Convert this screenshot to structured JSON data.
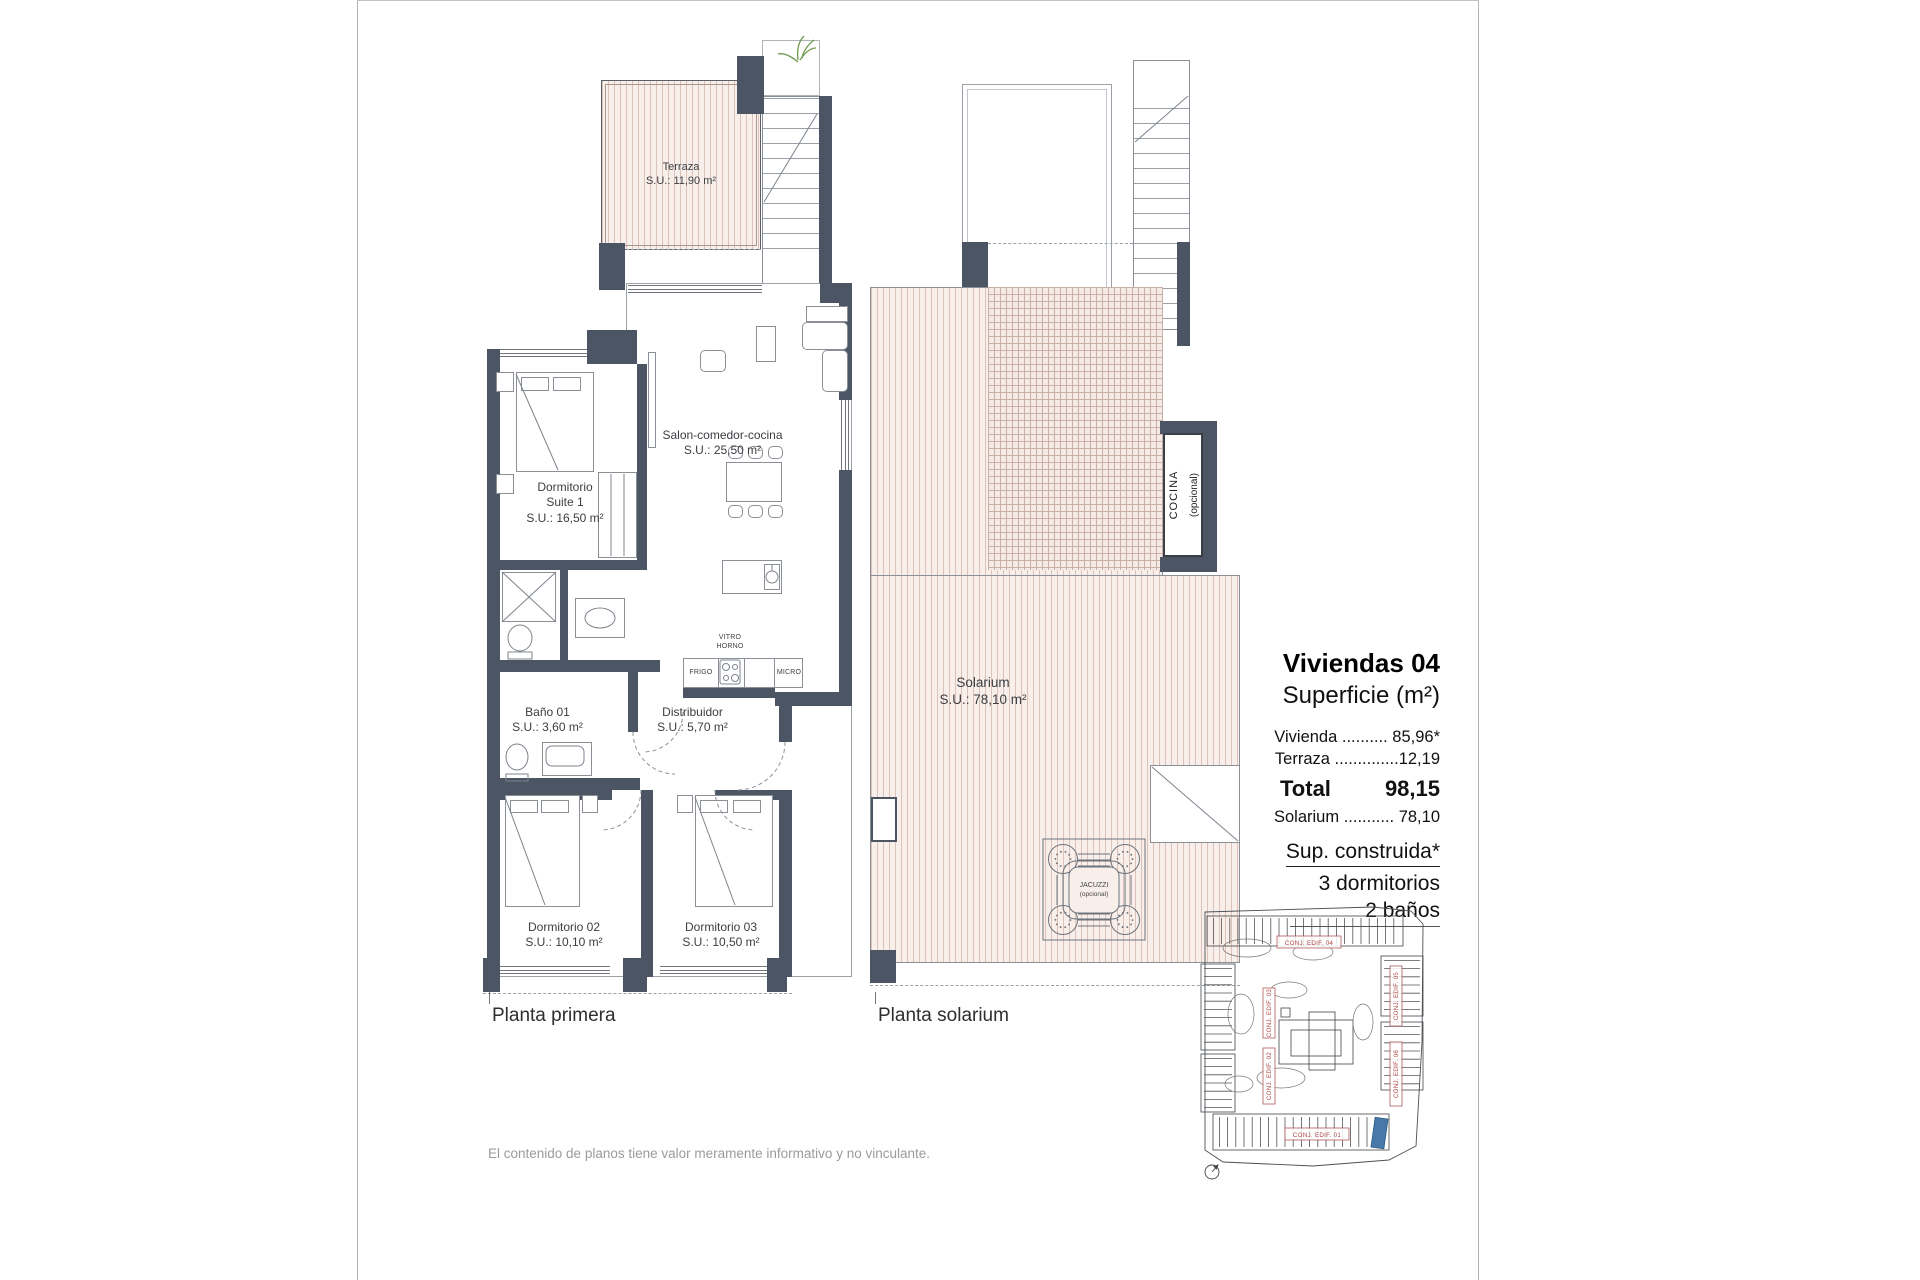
{
  "sheet": {
    "footer": "El contenido de planos tiene valor meramente informativo y no vinculante."
  },
  "plan_primera": {
    "caption": "Planta primera",
    "rooms": {
      "terraza": {
        "name": "Terraza",
        "area": "S.U.: 11,90 m²"
      },
      "suite": {
        "line1": "Dormitorio",
        "line2": "Suite 1",
        "area": "S.U.: 16,50 m²"
      },
      "salon": {
        "name": "Salon-comedor-cocina",
        "area": "S.U.: 25,50 m²"
      },
      "bano01": {
        "name": "Baño 01",
        "area": "S.U.: 3,60 m²"
      },
      "distribuidor": {
        "name": "Distribuidor",
        "area": "S.U.: 5,70 m²"
      },
      "dorm02": {
        "name": "Dormitorio 02",
        "area": "S.U.: 10,10 m²"
      },
      "dorm03": {
        "name": "Dormitorio 03",
        "area": "S.U.: 10,50 m²"
      }
    },
    "kitchen": {
      "vitro": "VITRO",
      "horno": "HORNO",
      "frigo": "FRIGO",
      "micro": "MICRO"
    }
  },
  "plan_solarium": {
    "caption": "Planta solarium",
    "rooms": {
      "solarium": {
        "name": "Solarium",
        "area": "S.U.: 78,10 m²"
      },
      "cocina": {
        "line1": "COCINA",
        "line2": "(opcional)"
      },
      "jacuzzi": {
        "line1": "JACUZZI",
        "line2": "(opcional)"
      }
    }
  },
  "info_panel": {
    "title": "Viviendas 04",
    "subtitle": "Superficie (m²)",
    "vivienda_row": "Vivienda .......... 85,96*",
    "terraza_row": "Terraza ..............12,19",
    "total_label": "Total",
    "total_value": "98,15",
    "solarium_row": "Solarium ........... 78,10",
    "built_title": "Sup. construida*",
    "bedrooms_line": "3 dormitorios",
    "bathrooms_line": "2 baños"
  },
  "site_map": {
    "labels": {
      "edif01": "CONJ. EDIF. 01",
      "edif02": "CONJ. EDIF. 02",
      "edif03": "CONJ. EDIF. 03",
      "edif04": "CONJ. EDIF. 04",
      "edif05": "CONJ. EDIF. 05",
      "edif06": "CONJ. EDIF. 06"
    },
    "highlight_color": "#4878a8",
    "label_color": "#b04848"
  },
  "colors": {
    "wall": "#4b5563",
    "hatch_bg": "#f8efeb",
    "hatch_line": "#dcc2b8",
    "footer_text": "#9b9b9b"
  }
}
